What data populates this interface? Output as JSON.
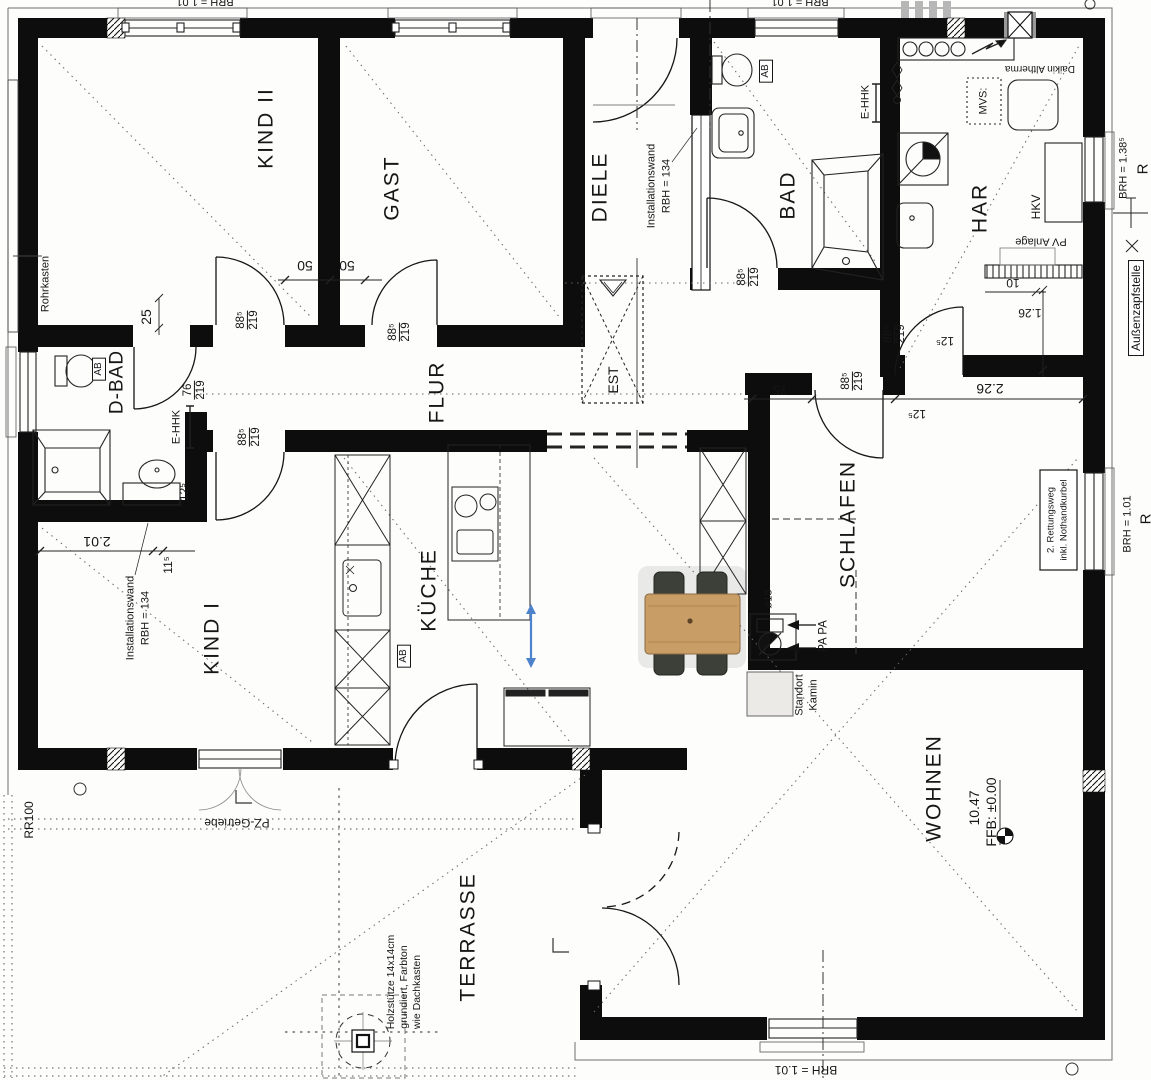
{
  "plan": {
    "rooms": {
      "kind2": "KIND II",
      "gast": "GAST",
      "diele": "DIELE",
      "bad": "BAD",
      "har": "HAR",
      "dbad": "D-BAD",
      "flur": "FLUR",
      "kind1": "KIND I",
      "kueche": "KÜCHE",
      "schlafen": "SCHLAFEN",
      "wohnen": "WOHNEN",
      "terrasse": "TERRASSE",
      "est": "EST"
    },
    "annotations": {
      "rohrkasten": "Rohrkasten",
      "installationswand": "Installationswand",
      "rbh134": "RBH = 134",
      "ehhk": "E-HHK",
      "ab": "AB",
      "mvs": "MVS:",
      "daikin": "Daikin Altherma",
      "hkv": "HKV",
      "pv_anlage": "PV Anlage",
      "aussenzapfstelle": "Außenzapfstelle",
      "brh138": "BRH = 1.38⁵",
      "brh101": "BRH = 1.01",
      "r": "R",
      "rettungsweg1": "2. Rettungsweg",
      "rettungsweg2": "inkl. Nothandkurbel",
      "d18": "ø18",
      "papa": "PA PA",
      "standort": "Standort",
      "kamin": "Kamin",
      "area_wohnen": "10.47",
      "ffb": "FFB: ±0.00",
      "holz1": "Holzstütze 14x14cm",
      "holz2": "grundiert, Farbton",
      "holz3": "wie Dachkasten",
      "rr100": "RR100",
      "pz_getriebe": "PZ-Getriebe"
    },
    "dims": {
      "d25": "25",
      "d50": "50",
      "w885": "88⁵",
      "h219": "219",
      "w76": "76",
      "d125": "12⁵",
      "d201": "2.01",
      "d115": "11⁵",
      "d226": "2.26",
      "d126": "1.26",
      "d10": "10",
      "d75": "75"
    },
    "colors": {
      "wall": "#0d0d0d",
      "accent_arrow": "#4d82cc",
      "wood": "#c99d66"
    }
  }
}
